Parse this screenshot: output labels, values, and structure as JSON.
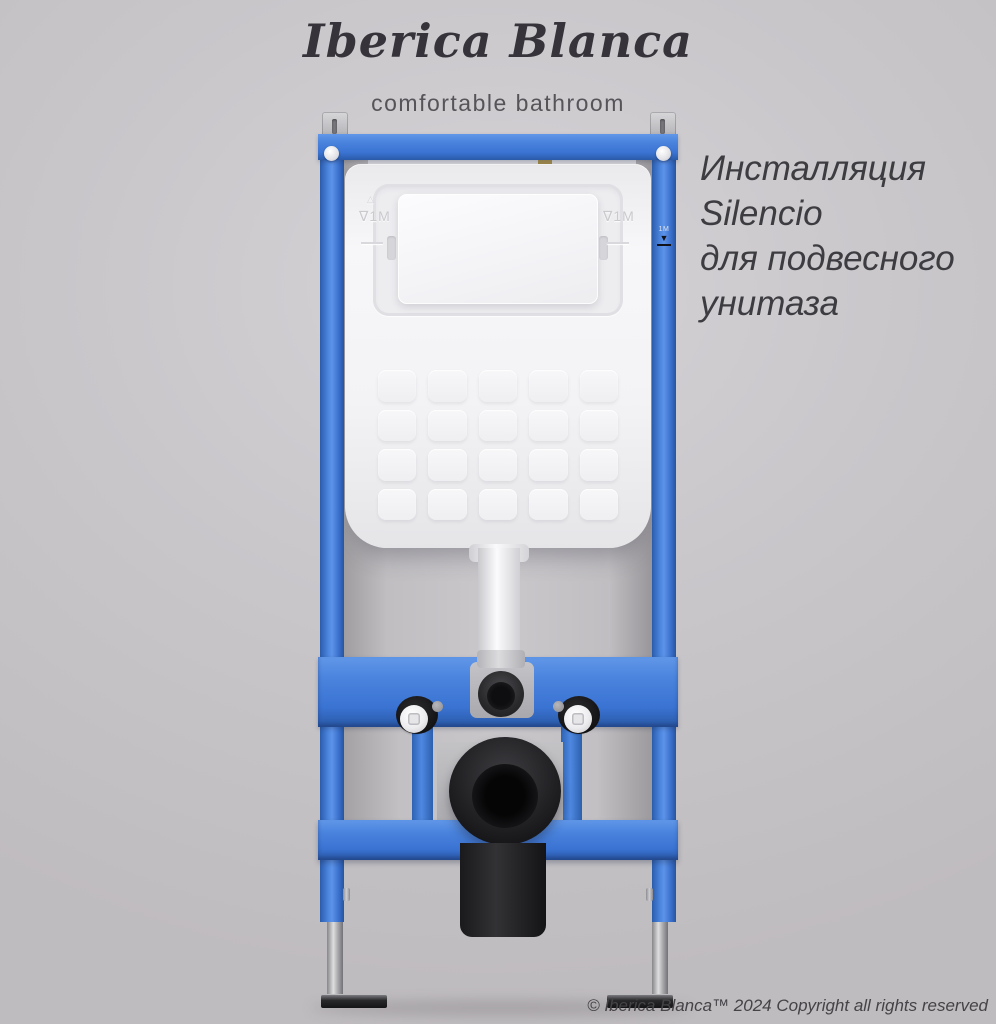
{
  "header": {
    "brand": "Iberica Blanca",
    "tagline": "comfortable bathroom"
  },
  "product_text": {
    "lines": [
      "Инсталляция",
      "Silencio",
      "для подвесного",
      "унитаза"
    ]
  },
  "footer": {
    "copyright": "© Iberica Blanca™ 2024 Copyright all rights reserved"
  },
  "product": {
    "markings": {
      "cistern_left": "∇1M",
      "cistern_left_triangle": "△",
      "cistern_right": "∇1M",
      "rail_right": "1M"
    },
    "colors": {
      "background_gray": "#c6c4c7",
      "frame_blue": "#3d77d6",
      "frame_blue_light": "#5d93e8",
      "frame_blue_dark": "#2a5aa8",
      "cistern_white": "#f4f4f6",
      "drain_black": "#1c1c1e",
      "fitting_dark_gray": "#2a2a2d",
      "chrome": "#a8a8ac",
      "brass": "#b29a55",
      "text_dark": "#3d3c40"
    }
  }
}
